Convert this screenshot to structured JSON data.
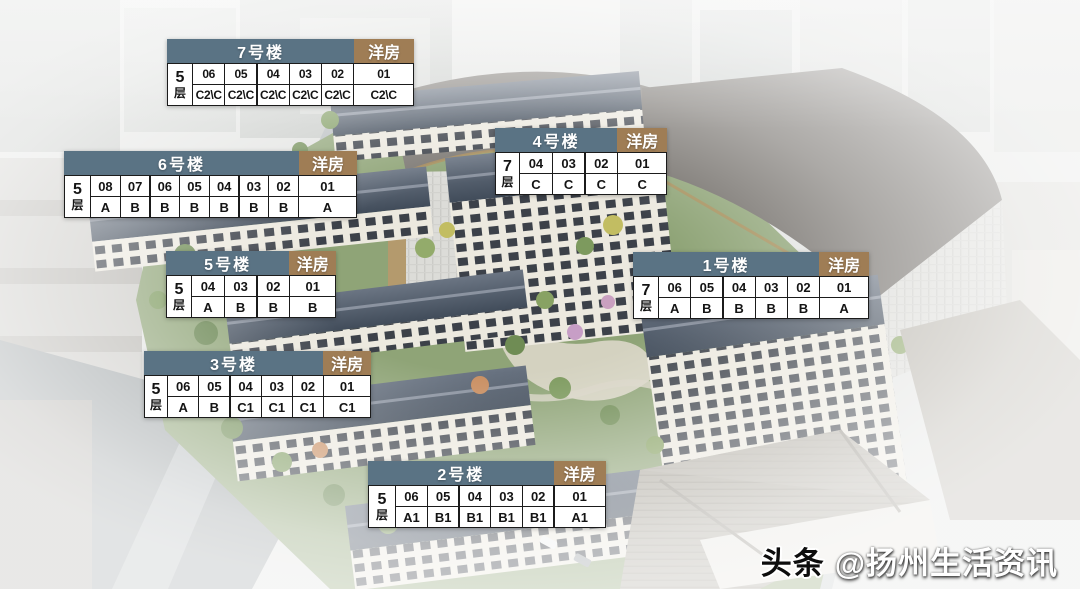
{
  "watermark": {
    "brand": "头条",
    "handle": "@扬州生活资讯"
  },
  "colors": {
    "table_header_bg": "#5a7384",
    "housing_tag_bg": "#9f7d55",
    "table_cell_bg": "#ffffff",
    "table_border": "#1b1b1b",
    "table_header_text": "#ffffff",
    "table_cell_text": "#141414",
    "roof": "#4c5765",
    "greenery": "#8fa477"
  },
  "tables": [
    {
      "key": "b7",
      "name": "7号楼",
      "tag": "洋房",
      "floor_count": "5",
      "floor_suffix": "层",
      "units": [
        "06",
        "05",
        "04",
        "03",
        "02",
        "01"
      ],
      "types": [
        "C2\\C",
        "C2\\C",
        "C2\\C",
        "C2\\C",
        "C2\\C",
        "C2\\C"
      ]
    },
    {
      "key": "b6",
      "name": "6号楼",
      "tag": "洋房",
      "floor_count": "5",
      "floor_suffix": "层",
      "units": [
        "08",
        "07",
        "06",
        "05",
        "04",
        "03",
        "02",
        "01"
      ],
      "types": [
        "A",
        "B",
        "B",
        "B",
        "B",
        "B",
        "B",
        "A"
      ]
    },
    {
      "key": "b4",
      "name": "4号楼",
      "tag": "洋房",
      "floor_count": "7",
      "floor_suffix": "层",
      "units": [
        "04",
        "03",
        "02",
        "01"
      ],
      "types": [
        "C",
        "C",
        "C",
        "C"
      ]
    },
    {
      "key": "b5",
      "name": "5号楼",
      "tag": "洋房",
      "floor_count": "5",
      "floor_suffix": "层",
      "units": [
        "04",
        "03",
        "02",
        "01"
      ],
      "types": [
        "A",
        "B",
        "B",
        "B"
      ]
    },
    {
      "key": "b1",
      "name": "1号楼",
      "tag": "洋房",
      "floor_count": "7",
      "floor_suffix": "层",
      "units": [
        "06",
        "05",
        "04",
        "03",
        "02",
        "01"
      ],
      "types": [
        "A",
        "B",
        "B",
        "B",
        "B",
        "A"
      ]
    },
    {
      "key": "b3",
      "name": "3号楼",
      "tag": "洋房",
      "floor_count": "5",
      "floor_suffix": "层",
      "units": [
        "06",
        "05",
        "04",
        "03",
        "02",
        "01"
      ],
      "types": [
        "A",
        "B",
        "C1",
        "C1",
        "C1",
        "C1"
      ]
    },
    {
      "key": "b2",
      "name": "2号楼",
      "tag": "洋房",
      "floor_count": "5",
      "floor_suffix": "层",
      "units": [
        "06",
        "05",
        "04",
        "03",
        "02",
        "01"
      ],
      "types": [
        "A1",
        "B1",
        "B1",
        "B1",
        "B1",
        "A1"
      ]
    }
  ]
}
